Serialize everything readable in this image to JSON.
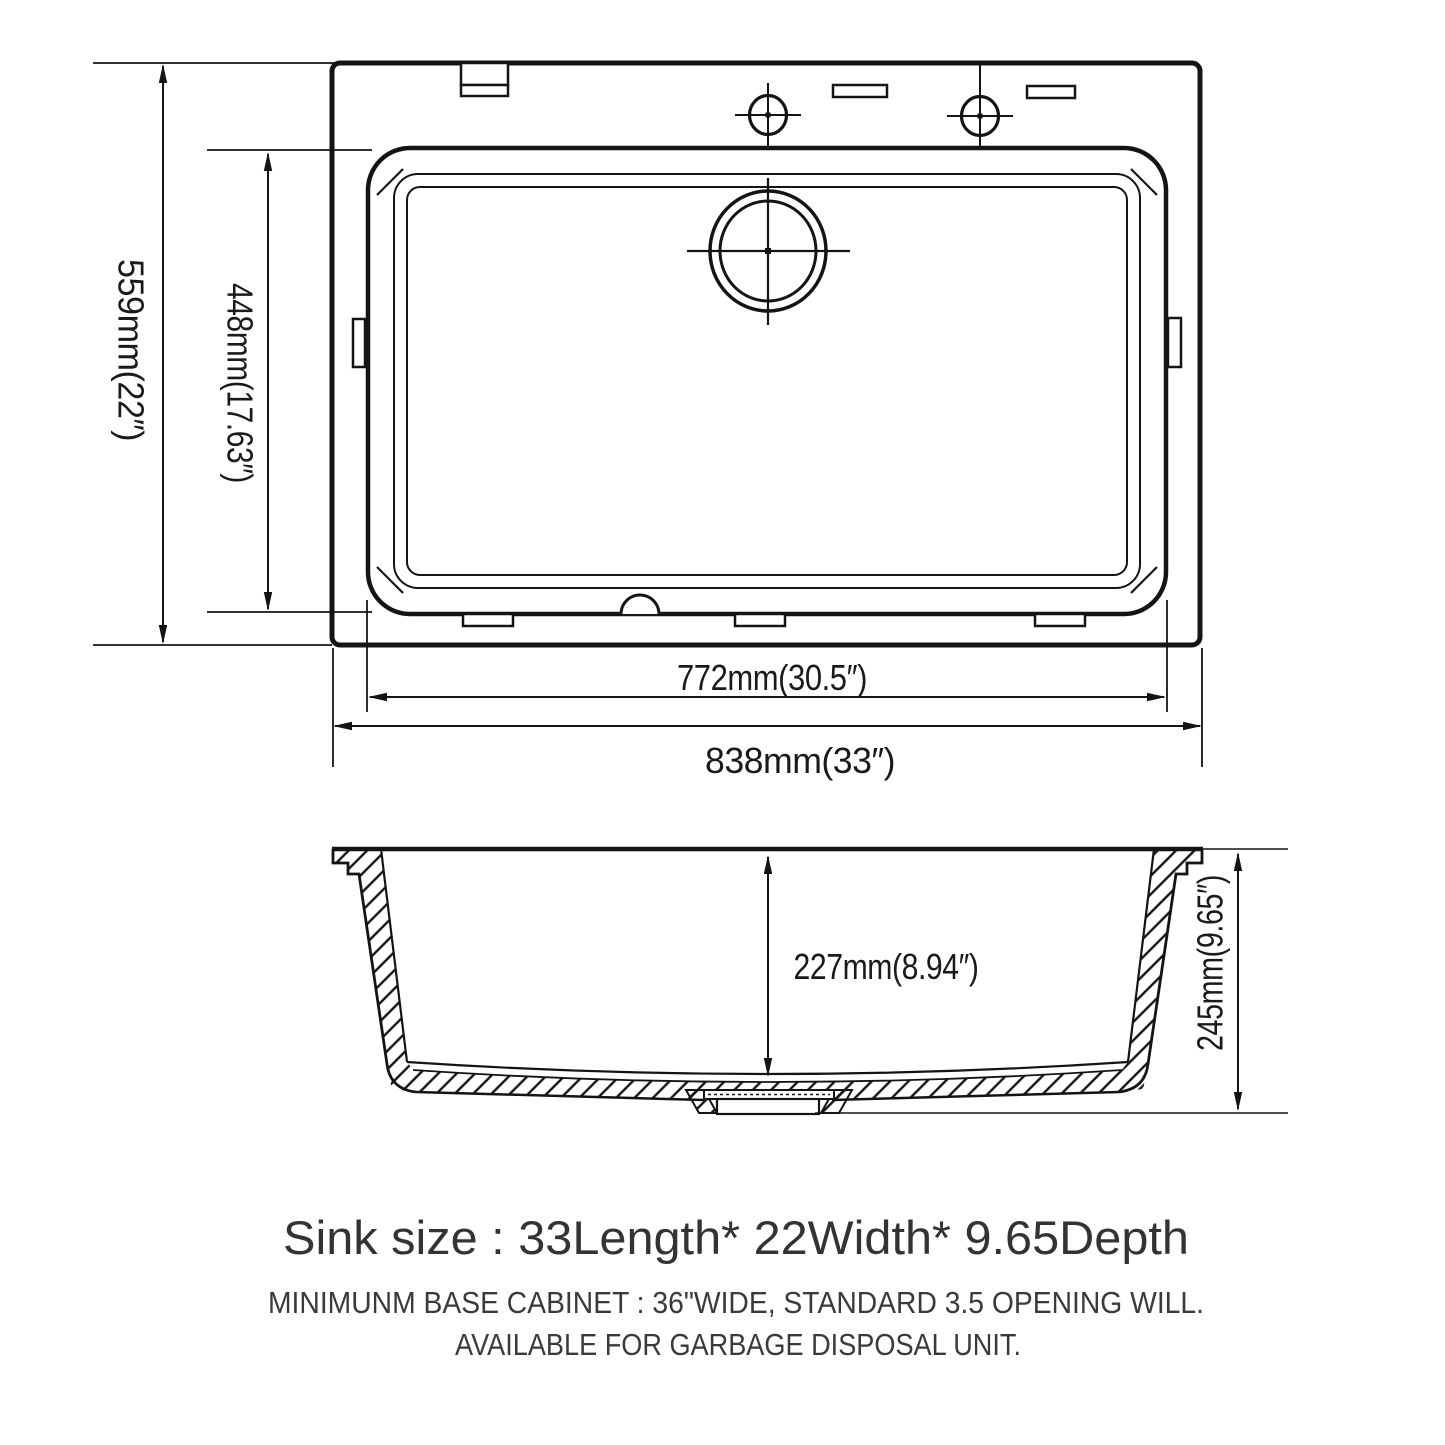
{
  "diagram": {
    "dims": {
      "overall_width_label": "559mm(22″)",
      "inner_width_label": "448mm(17.63″)",
      "inner_length_label": "772mm(30.5″)",
      "overall_length_label": "838mm(33″)",
      "inner_depth_label": "227mm(8.94″)",
      "overall_depth_label": "245mm(9.65″)"
    },
    "notes": {
      "size_line": "Sink size :  33Length* 22Width* 9.65Depth",
      "cabinet_line": "MINIMUNM BASE CABINET : 36\"WIDE,  STANDARD 3.5 OPENING WILL.",
      "disposal_line": "AVAILABLE FOR GARBAGE DISPOSAL UNIT."
    },
    "colors": {
      "line": "#141414",
      "note_text": "#333333",
      "background": "#ffffff"
    }
  }
}
